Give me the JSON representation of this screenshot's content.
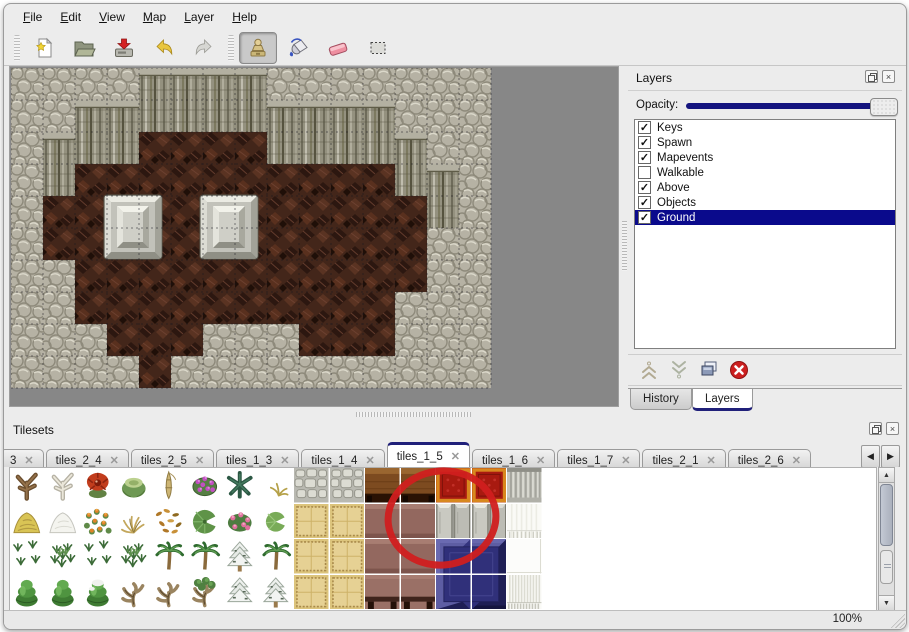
{
  "menu_bar": {
    "items": [
      "File",
      "Edit",
      "View",
      "Map",
      "Layer",
      "Help"
    ]
  },
  "toolbar": {
    "buttons": [
      {
        "name": "new-map-button",
        "icon": "new-file-icon",
        "group": 0
      },
      {
        "name": "open-button",
        "icon": "open-folder-icon",
        "group": 0
      },
      {
        "name": "save-button",
        "icon": "save-icon",
        "group": 0
      },
      {
        "name": "undo-button",
        "icon": "undo-arrow-icon",
        "group": 0
      },
      {
        "name": "redo-button",
        "icon": "redo-arrow-icon",
        "group": 0
      },
      {
        "name": "stamp-tool-button",
        "icon": "stamp-icon",
        "group": 1,
        "active": true
      },
      {
        "name": "fill-tool-button",
        "icon": "fill-bucket-icon",
        "group": 1
      },
      {
        "name": "eraser-tool-button",
        "icon": "eraser-icon",
        "group": 1
      },
      {
        "name": "select-tool-button",
        "icon": "selection-icon",
        "group": 1
      }
    ]
  },
  "map_editor": {
    "tile_size": 32,
    "legend": {
      "S": "rock-floor",
      "C": "cliff-wall",
      "B": "cave-ground"
    },
    "grid": [
      "SSSSCCCCSSSSSSS",
      "SSCCCCCCCCCCSSS",
      "SCCCBBBBCCCCCSS",
      "SCBBBBBBBBBBCCS",
      "SBBBBBBBBBBBBCS",
      "SBBBBBBBBBBBBSS",
      "SSBBBBBBBBBBBSS",
      "SSBBBBBBBBBBSSS",
      "SSSBBBSSSBBBSSS",
      "SSSSBSSSSSSSSSS"
    ],
    "objects": [
      {
        "name": "stone-block",
        "x": 93,
        "y": 127
      },
      {
        "name": "stone-block",
        "x": 189,
        "y": 127
      }
    ]
  },
  "layers_panel": {
    "title": "Layers",
    "opacity_label": "Opacity:",
    "opacity_percent": 100,
    "layers": [
      {
        "name": "Keys",
        "visible": true,
        "selected": false
      },
      {
        "name": "Spawn",
        "visible": true,
        "selected": false
      },
      {
        "name": "Mapevents",
        "visible": true,
        "selected": false
      },
      {
        "name": "Walkable",
        "visible": false,
        "selected": false
      },
      {
        "name": "Above",
        "visible": true,
        "selected": false
      },
      {
        "name": "Objects",
        "visible": true,
        "selected": false
      },
      {
        "name": "Ground",
        "visible": true,
        "selected": true
      }
    ],
    "buttons": [
      "raise-layer",
      "lower-layer",
      "duplicate-layer",
      "delete-layer"
    ],
    "tabs": [
      {
        "label": "History",
        "active": false
      },
      {
        "label": "Layers",
        "active": true
      }
    ]
  },
  "tilesets_panel": {
    "title": "Tilesets",
    "tabs": [
      {
        "label": "3",
        "active": false,
        "truncated": true
      },
      {
        "label": "tiles_2_4",
        "active": false
      },
      {
        "label": "tiles_2_5",
        "active": false
      },
      {
        "label": "tiles_1_3",
        "active": false
      },
      {
        "label": "tiles_1_4",
        "active": false
      },
      {
        "label": "tiles_1_5",
        "active": true
      },
      {
        "label": "tiles_1_6",
        "active": false
      },
      {
        "label": "tiles_1_7",
        "active": false
      },
      {
        "label": "tiles_2_1",
        "active": false
      },
      {
        "label": "tiles_2_6",
        "active": false
      }
    ],
    "palette_rows": [
      [
        "dead-tree",
        "coral-tree",
        "red-flower",
        "stump",
        "bamboo",
        "purple-flowers",
        "dark-palm",
        "dry-plant",
        "cobble",
        "cobble",
        "wood-top",
        "wood-top",
        "red-carpet",
        "red-carpet",
        "curtain-gray"
      ],
      [
        "hay",
        "snow-pile",
        "orange-flowers",
        "dry-grass",
        "leaves",
        "lily-pad",
        "rose-bush",
        "lily-pad2",
        "tan-carpet",
        "tan-carpet",
        "mauve",
        "mauve",
        "metal-block",
        "metal-block",
        "curtain-white"
      ],
      [
        "weeds",
        "weed-clump",
        "weeds",
        "weed-clump",
        "palm",
        "palm",
        "snow-tree",
        "palm-tall",
        "tan-carpet",
        "tan-carpet",
        "mauve",
        "mauve",
        "blue-tl",
        "blue-tr",
        "white-tile"
      ],
      [
        "conifer",
        "conifer",
        "conifer-snow",
        "twisted-tree",
        "twisted-tree",
        "twisted-green",
        "snow-pine",
        "snow-pine-tall",
        "tan-carpet",
        "tan-carpet",
        "table-brown",
        "table-brown",
        "blue-bl",
        "blue-br",
        "curtain-fringe"
      ]
    ],
    "annotation_circle": {
      "color": "#d01f1f",
      "center_x": 437,
      "center_y": 565,
      "rx": 54,
      "ry": 47
    }
  },
  "status_bar": {
    "zoom_level": "100%"
  },
  "colors": {
    "selection_highlight": "#0a0a8c",
    "tab_accent": "#20207a",
    "slider_track": "#14147e",
    "canvas_background": "#878787"
  }
}
